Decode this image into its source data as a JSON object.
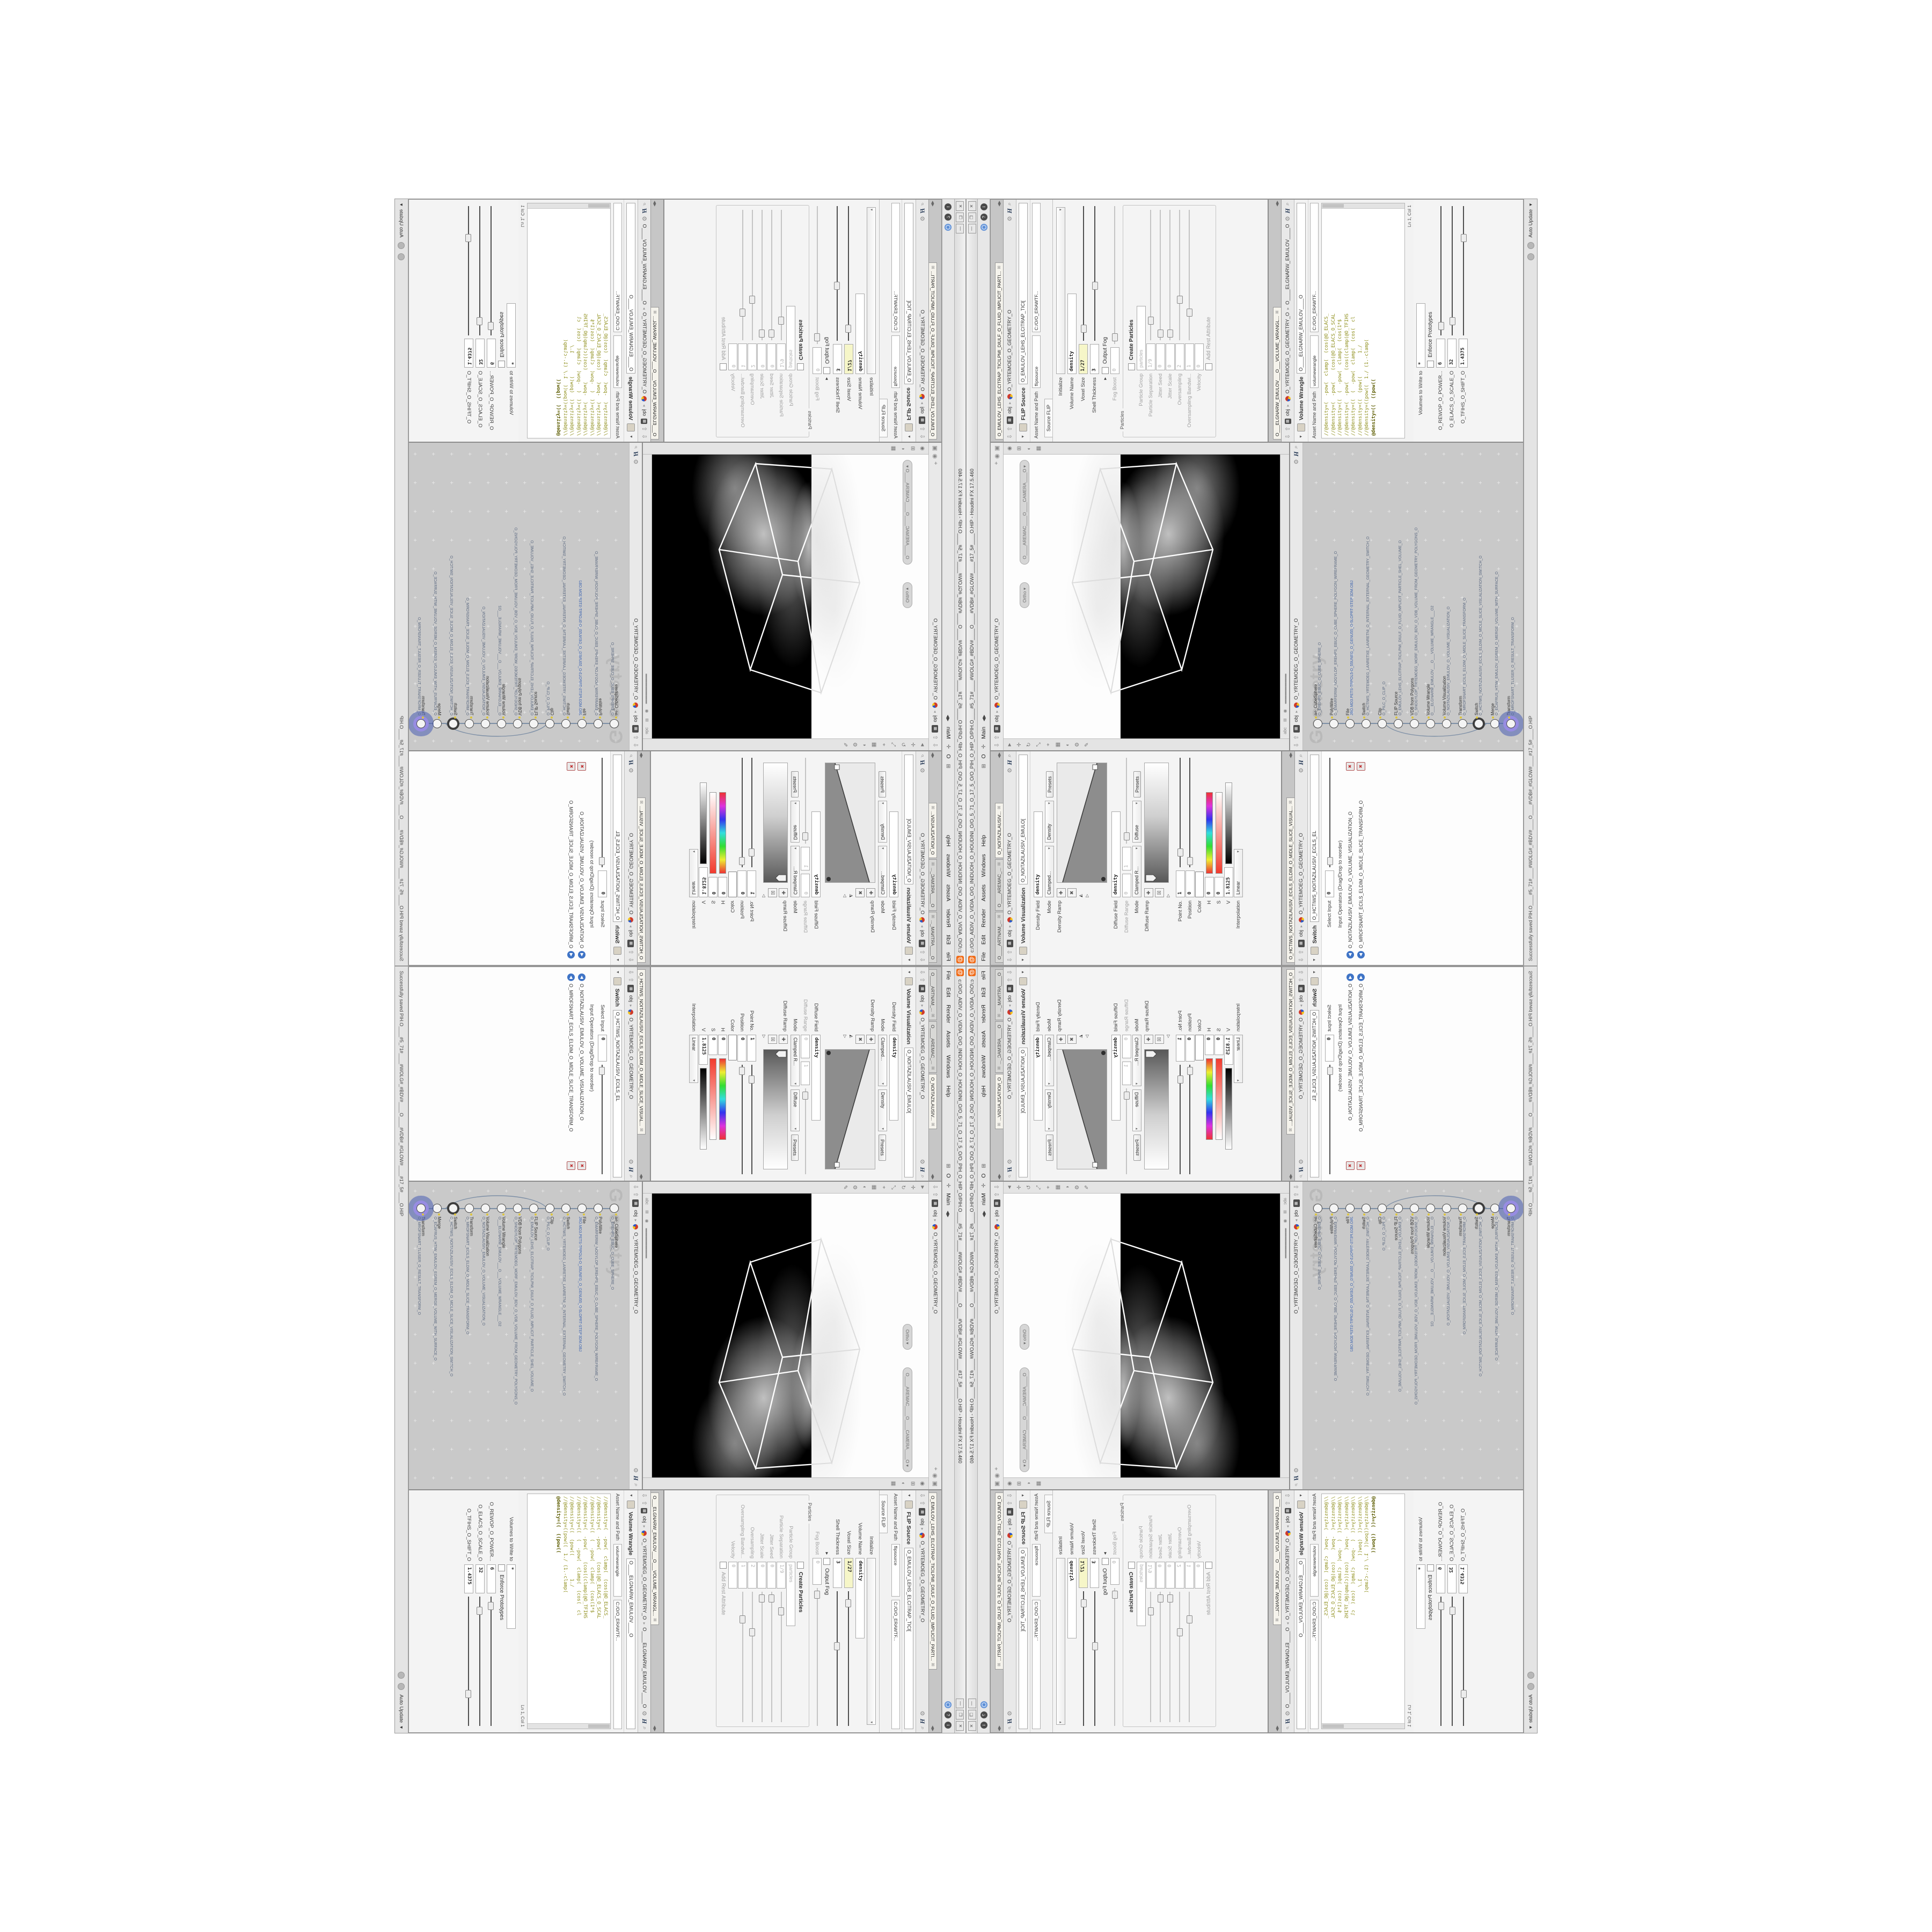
{
  "window": {
    "title": "c:/O/O_AIDIV_O_VIDIA_O/O_INIDUOH_O_HOUDINI_O/O_5_71_O_17_5_O/O_PIH_O_HIP_O/PIH.O____#5_71#____#WOLG#_#BDV#____O____#VDB#_#GLOW#____#17_5#____O.HIP - Houdini FX 17.5.460",
    "minimize": "—",
    "maximize": "❐",
    "close": "✕",
    "logo_glyph": "@"
  },
  "menubar": {
    "items": [
      "File",
      "Edit",
      "Render",
      "Assets",
      "Windows",
      "Help"
    ],
    "desktop_o": "O",
    "desktop_main": "Main",
    "help_badge": "?",
    "info_badge": "i"
  },
  "icons": {
    "up": "⇧",
    "down": "⇩",
    "gear": "⚙",
    "search": "⌕",
    "clapper": "▦",
    "pin": "⌖",
    "radar": "◉",
    "cube": "▣",
    "camera": "▾",
    "select": "►",
    "translate": "✛",
    "rotate": "↻",
    "scale": "⤡",
    "handles": "⌖",
    "snap": "▦",
    "shade": "◐",
    "settings": "⚙",
    "pen": "✎",
    "abc": "abc",
    "quadview": "⊞",
    "eye": "◉"
  },
  "breadcrumb": {
    "root": "obj",
    "geo": "O_YRTEMOEG_O_GEOMETRY_O",
    "wrangle": "O____ELGNARW_EMULOV____O"
  },
  "viewport": {
    "camera_pill": "O____AREMAC____O____CAMERA____O",
    "ortho_pill": "Ortho"
  },
  "network": {
    "watermark": "Geometry",
    "nodes": [
      {
        "type": "ae_CubeSphere",
        "name": "O_EREHPS_EBUC_O_CUBE_SPHERE_O",
        "cls": ""
      },
      {
        "type": "PolyWire",
        "name": "O_EMARFERIW_NOGYLOP_EREHPS_EBUC_O_CUBE_SPHERE_POLYGON_WIREFRAME_O",
        "cls": ""
      },
      {
        "type": "File",
        "name": "JBO.MD3.PETS-TRPOL5-O_55UNEG_O_GENU55_O-5LOPRT-STEP.3DM.OBJ",
        "cls": "file"
      },
      {
        "type": "Switch",
        "name": "O_HCTIWS_YRTEMOEG_LANRETXE_LANRETNI_O_INTERNAL_EXTERNAL_GEOMETRY_SWITCH_O",
        "cls": ""
      },
      {
        "type": "Clip",
        "name": "O_PILC_O_CLIP_O",
        "cls": ""
      },
      {
        "type": "FLIP Source",
        "name": "O_EMULOV_LEHS_ELCITRAP_TICILPMI_DIULF_O_FLUID_IMPLICIT_PARTICLE_SHEL_VOLUME_O",
        "cls": ""
      },
      {
        "type": "VDB from Polygons",
        "name": "O_SNOGYLOP_YRTEMOEG_MORF_EMULOV_BDV_O_VDB_VOLUME_FROM_GEOMETRY_POLYGONS_O",
        "cls": ""
      },
      {
        "type": "Volume Wrangle",
        "name": "O___ELGNARW_EMULOV___O___VOLUME_WRANGLE___O2",
        "cls": ""
      },
      {
        "type": "Volume Visualization",
        "name": "O_NOITAZILAUSIV_EMULOV_O_VOLUME_VISUALIZATION_O",
        "cls": ""
      },
      {
        "type": "Transform",
        "name": "O_MROFSNART_ECILS_ELDIM_O_MIDLE_SLICE_TRANSFORM_O",
        "cls": ""
      },
      {
        "type": "Switch",
        "name": "O_HCTIWS_NOITAZILAUSIV_ECILS_ELDIM_O_MIDLE_SLICE_VISUALIZATION_SWITCH_O",
        "cls": "ring"
      },
      {
        "type": "Merge",
        "name": "O_ECAFRUS_HTIW_EMULOV_EGREM_O_MERGE_VOLUME_WITH_SURFACE_O",
        "cls": ""
      },
      {
        "type": "Transform",
        "name": "O_MROFSNART_TLUSER_O_RESULT_TRANSFORM_O",
        "cls": "selected"
      }
    ]
  },
  "volviz": {
    "tabs": [
      "O____ARTNAM_...",
      "O____AREMAC_...",
      "O_NOITAZILAUSIV..."
    ],
    "node_type": "Volume Visualization",
    "node_name": "O_NOITAZILAUSIV_EMULO[",
    "density_field_label": "Density Field",
    "density_field": "density",
    "mode1_label": "Mode",
    "mode1": "Clamped...",
    "presets1_tag": "Density",
    "presets_btn": "Presets",
    "density_ramp_label": "Density Ramp",
    "diffuse_field_label": "Diffuse Field",
    "diffuse_field": "density",
    "diffuse_range_label": "Diffuse Range",
    "diffuse_range_min": "0",
    "diffuse_range_max": "1",
    "mode2_label": "Mode",
    "mode2": "Clamped R...",
    "presets2_tag": "Diffuse",
    "diffuse_ramp_label": "Diffuse Ramp",
    "point_label": "Point No.",
    "point": "1",
    "pos_label": "Position",
    "pos": "0",
    "color_label": "Color",
    "h_label": "H",
    "h": "0",
    "s_label": "S",
    "s": "0",
    "v_label": "V",
    "v": "1.8125",
    "interp_label": "Interpolation",
    "interp": "Linear"
  },
  "switchpane": {
    "tab": "O_HCTIWS_NOITAZILAUSIV_ECILS_ELDIM_O_MIDLE_SLICE_VISUAL...",
    "node_type": "Switch",
    "node_name": "O_HCTIWS_NOITAZILAUSIV_ECILS_EL",
    "select_label": "Select Input",
    "select": "0",
    "list_label": "Input Operators (Drag/Drop to reorder)",
    "inputs": [
      "O_NOITAZILAUSIV_EMULOV_O_VOLUME_VISUALIZATION_O",
      "O_MROFSNART_ECILS_ELDIM_O_MIDLE_SLICE_TRANSFORM_O"
    ]
  },
  "flip": {
    "tab": "O_EMULOV_LEHS_ELCITRAP_TICILPMI_DIULF_O_FLUID_IMPLICIT_PARTI...",
    "node_type": "FLIP Source",
    "node_name": "O_EMULOV_LEHS_ELCITRAP_TICI[",
    "asset_label": "Asset Name and Path",
    "asset_name": "flipsource",
    "asset_path": "C:/O/O_ERAWTF...",
    "param_tab": "Source FLIP",
    "initialize_label": "Initialize",
    "volume_name_label": "Volume Name",
    "volume_name": "density",
    "voxel_label": "Voxel Size",
    "voxel": "1/27",
    "shell_label": "Shell Thickness",
    "shell": "3",
    "output_fog_label": "Output Fog",
    "fog_boost_label": "Fog Boost",
    "fog_boost": "0",
    "particles_group": "Particles",
    "create_particles_label": "Create Particles",
    "pgroup_label": "Particle Group",
    "pgroup": "particles",
    "psep_label": "Particle Separation",
    "psep": "1/9",
    "jseed_label": "Jitter Seed",
    "jseed": "0",
    "jscale_label": "Jitter Scale",
    "jscale": "0",
    "oversampling_label": "Oversampling",
    "oversampling": "2",
    "obw_label": "Oversampling Bandwi...",
    "obw": "1",
    "velocity_label": "Velocity",
    "velocity": "0",
    "rest_label": "Add Rest Attribute"
  },
  "wrangle": {
    "tab": "O___ELGNARW_EMULOV___O___VOLUME_WRANGL...",
    "node_type": "Volume Wrangle",
    "node_name": "O____ELGNARW_EMULOV____O",
    "asset_label": "Asset Name and Path",
    "asset_name": "volumewrangle",
    "asset_path": "C:/O/O_ERAWTF...",
    "code_lines": [
      "//@density=(  -pow(  clamp(  (cos(@O_ELACS_",
      "//@density=(  -pow(    (cos(@O_ELACS_O_SCAL",
      "//@density=((  (  -pow(  clamp(  (cos(1*$",
      "//@density=(  -pow(    (cos((clamp(@O_TFIHS",
      "//@density=((  (  -pow(  clamp(  (cos(  cl",
      "//@density=((  (pow((        1./",
      "//@density=((pow((  1./ (1.-clamp("
    ],
    "active_line": "@density=((  ((pow((",
    "cursor_pos": "Ln 1, Col 1",
    "volumes_label": "Volumes to Write to",
    "volumes": "*",
    "enforce_label": "Enforce Prototypes",
    "power_label": "O_REWOP_O_POWER...",
    "power": "6",
    "scale_label": "O_ELACS_O_SCALE_O",
    "scale": "32",
    "shift_label": "O_TFIHS_O_SHIFT_O",
    "shift": "1.4375"
  },
  "statusbar": {
    "save_message": "Successfully saved PIH.O____#5_71#____#WOLG#_#BDV#____O____#VDB#_#GLOW#____#17_5#____O.HIP",
    "cook_mode": "Auto Update"
  }
}
